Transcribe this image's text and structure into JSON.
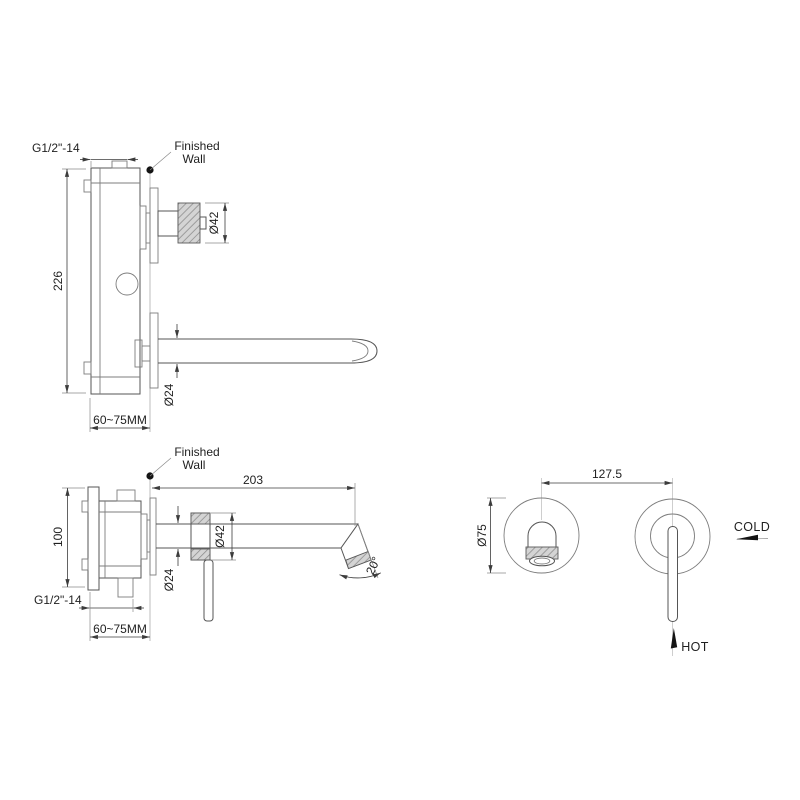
{
  "meta": {
    "background": "#ffffff",
    "line_color": "#555555",
    "dim_color": "#3c3c3c",
    "hatch_fill": "#d4d4d4",
    "hatch_line": "#8a8a8a"
  },
  "knob_view": {
    "thread": "G1/2\"-14",
    "wall_label1": "Finished",
    "wall_label2": "Wall",
    "body_height": "226",
    "wall_range": "60~75MM",
    "knob_diameter": "Ø42",
    "spout_diameter": "Ø24"
  },
  "lever_view": {
    "thread": "G1/2\"-14",
    "wall_label1": "Finished",
    "wall_label2": "Wall",
    "body_height": "100",
    "wall_range": "60~75MM",
    "spout_reach": "203",
    "trim_diameter": "Ø42",
    "spout_diameter": "Ø24",
    "spout_angle": "20°"
  },
  "front_view": {
    "centers_distance": "127.5",
    "escutcheon_diameter": "Ø75",
    "cold_label": "COLD",
    "hot_label": "HOT"
  }
}
